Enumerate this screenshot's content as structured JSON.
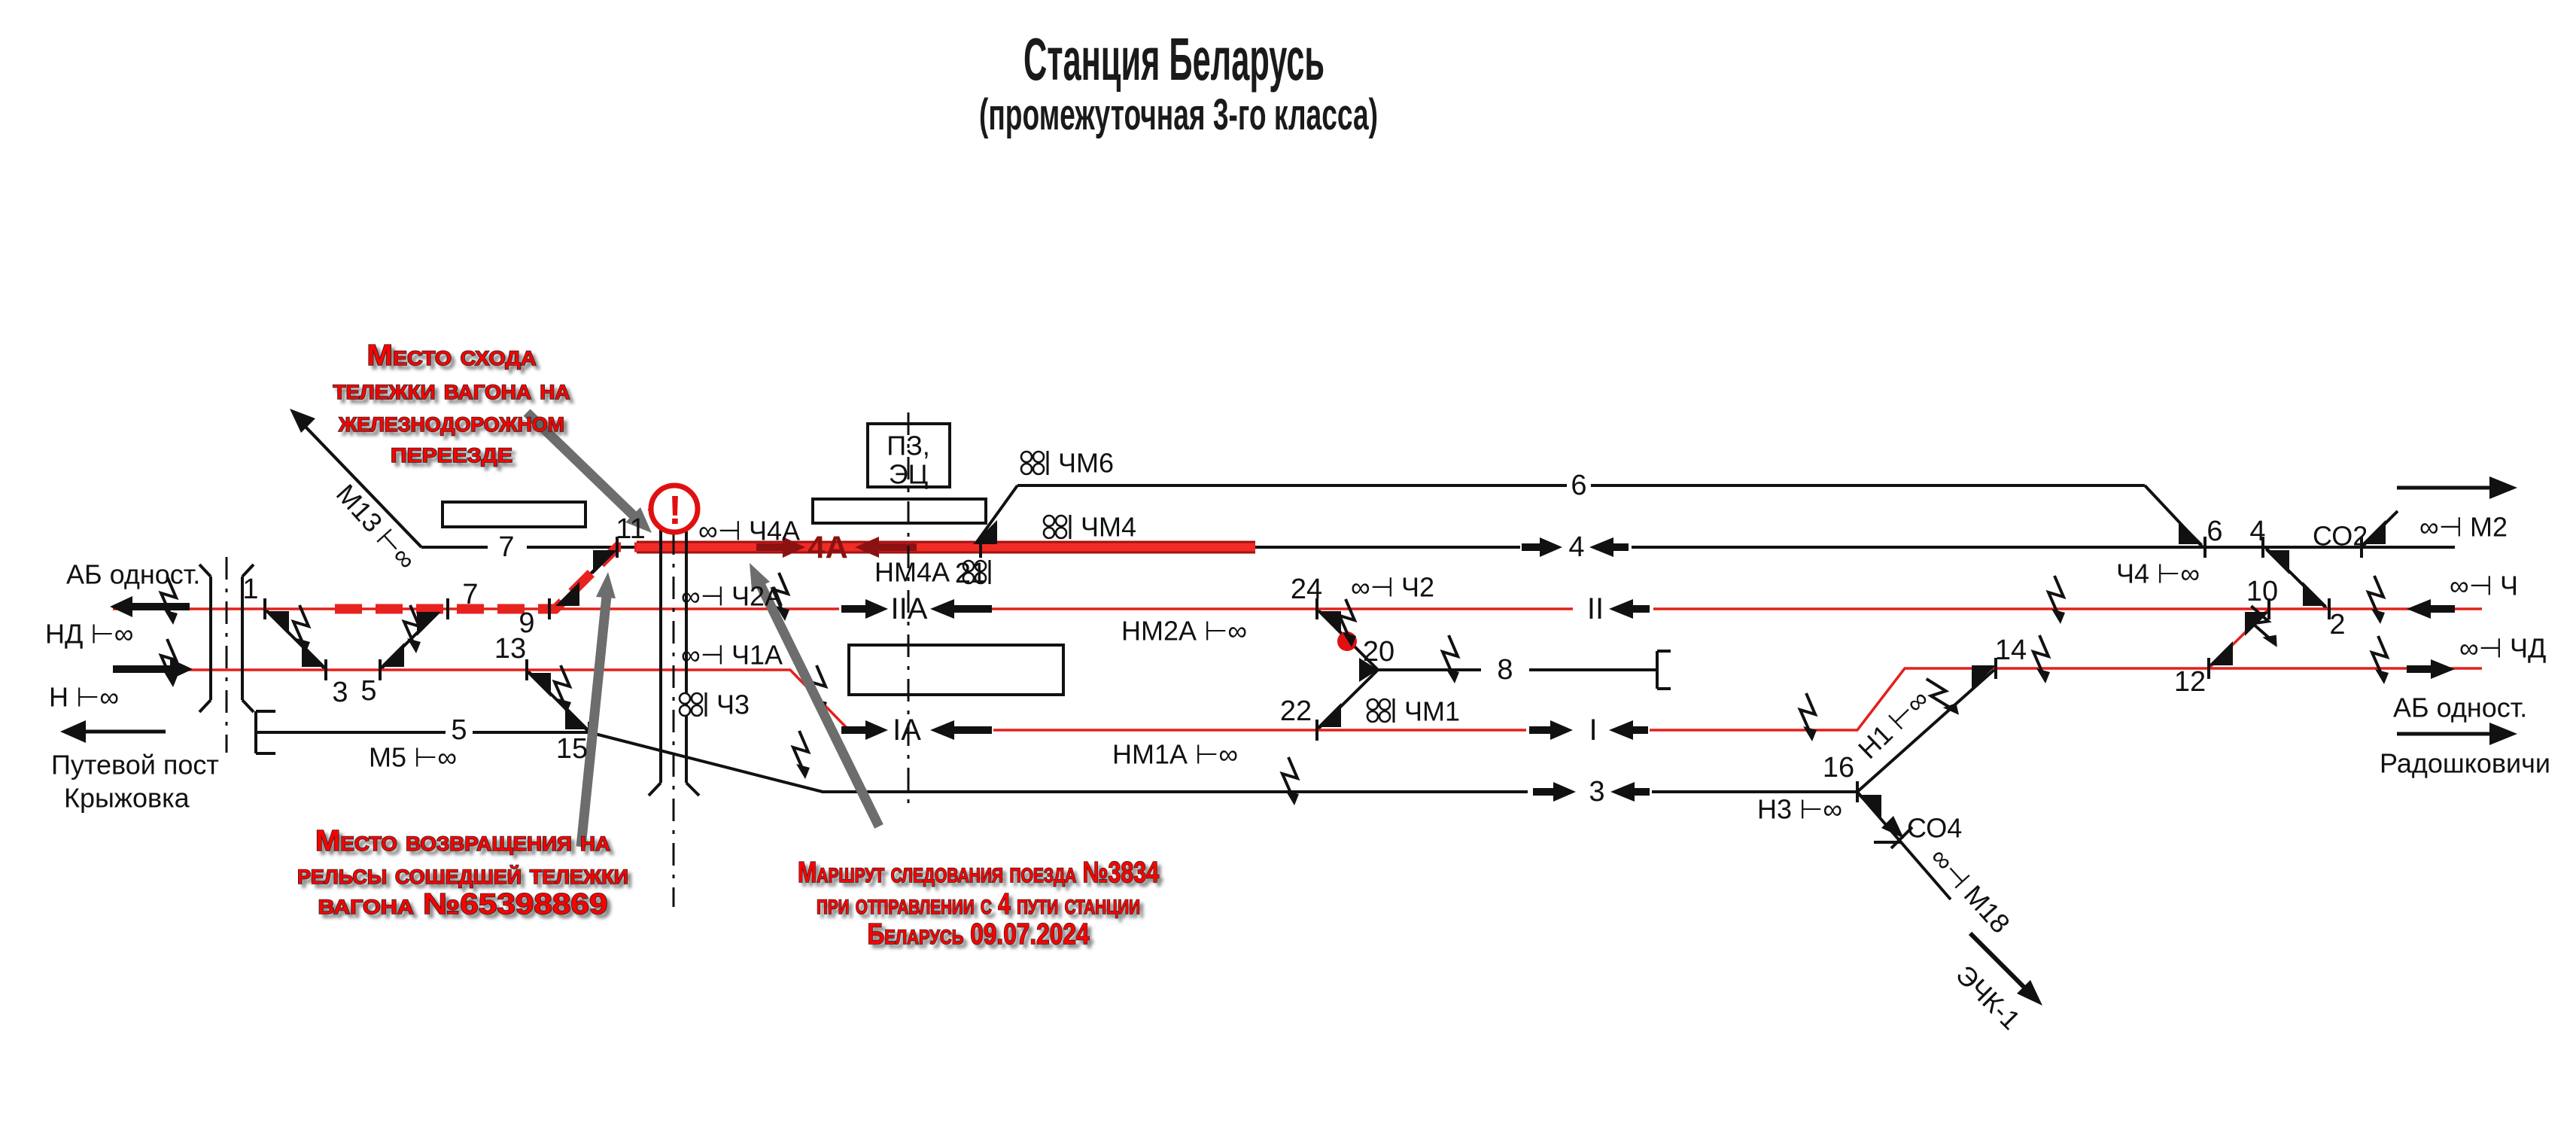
{
  "title": {
    "line1": "Станция Беларусь",
    "line2": "(промежуточная 3-го класса)"
  },
  "annotations": {
    "derail_site": {
      "lines": [
        "Место схода",
        "тележки вагона на",
        "железнодорожном",
        "переезде"
      ]
    },
    "rerail_site": {
      "lines": [
        "Место возвращения на",
        "рельсы сошедшей тележки",
        "вагона №65398869"
      ]
    },
    "route_note": {
      "lines": [
        "Маршрут следования поезда №3834",
        "при отправлении с 4 пути станции",
        "Беларусь 09.07.2024"
      ]
    }
  },
  "endpoints": {
    "left_block": "АБ одност.",
    "left_dest1": "Путевой пост",
    "left_dest2": "Крыжовка",
    "right_block": "АБ одност.",
    "right_dest": "Радошковичи"
  },
  "building": {
    "line1": "ПЗ,",
    "line2": "ЭЦ"
  },
  "alert": {
    "glyph": "!"
  },
  "signals": {
    "nd": "НД ⊢∞",
    "n": "Н ⊢∞",
    "m13": "М13 ⊢∞",
    "m5": "М5 ⊢∞",
    "ch4a": "∞⊣ Ч4А",
    "ch2a": "∞⊣ Ч2А",
    "ch1a": "∞⊣ Ч1А",
    "ch3": "Ч3",
    "chm6": "ЧМ6",
    "chm4": "ЧМ4",
    "nm4a": "НМ4А",
    "chm1": "ЧМ1",
    "ch2": "∞⊣ Ч2",
    "nm2a": "НМ2А ⊢∞",
    "nm1a": "НМ1А ⊢∞",
    "ch4": "Ч4 ⊢∞",
    "n1": "Н1 ⊢∞",
    "n3": "Н3 ⊢∞",
    "m2": "∞⊣ М2",
    "ch": "∞⊣ Ч",
    "chd": "∞⊣ ЧД",
    "m18": "∞⊣ М18",
    "co2": "СО2",
    "co4": "СО4",
    "echk": "ЭЧК-1"
  },
  "tracks": {
    "t7": "7",
    "t5": "5",
    "t8": "8",
    "t6": "6",
    "t4": "4",
    "tII": "II",
    "tI": "I",
    "t3": "3",
    "t4a": "4А",
    "tIIa": "IIА",
    "tIa": "IА"
  },
  "sw": {
    "s1": "1",
    "s3": "3",
    "s5": "5",
    "s7": "7",
    "s9": "9",
    "s11": "11",
    "s13": "13",
    "s15": "15",
    "s21": "21",
    "s24": "24",
    "s20": "20",
    "s22": "22",
    "s16": "16",
    "s14": "14",
    "s12": "12",
    "s10": "10",
    "s2": "2",
    "s6": "6",
    "s4": "4"
  },
  "colors": {
    "track_red": "#e3201c",
    "route_red": "#f12b26",
    "route_dark": "#8c1212",
    "annotation_red": "#ff0000",
    "arrow_gray": "#6d6d6d",
    "alert_red": "#e01010"
  }
}
